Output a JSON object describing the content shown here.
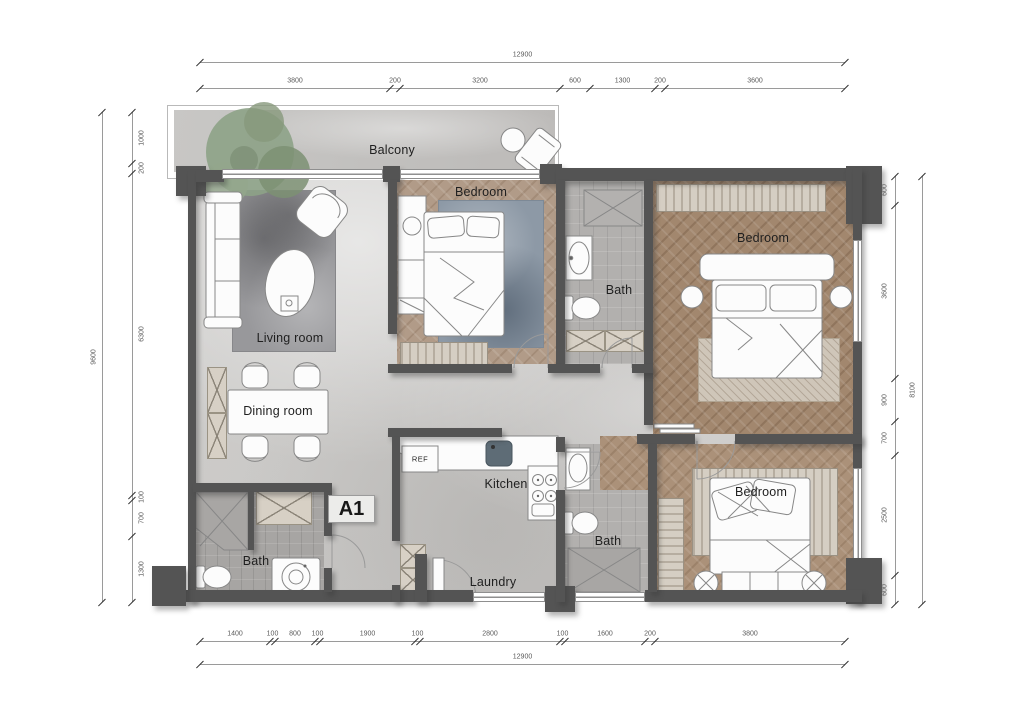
{
  "unit": {
    "label": "A1"
  },
  "rooms": {
    "balcony": "Balcony",
    "bedroom_top": "Bedroom",
    "bedroom_right": "Bedroom",
    "bedroom_bottom": "Bedroom",
    "bath_top": "Bath",
    "bath_bottom_left": "Bath",
    "bath_bottom_middle": "Bath",
    "living": "Living room",
    "dining": "Dining room",
    "kitchen": "Kitchen",
    "laundry": "Laundry",
    "fridge": "REF"
  },
  "dimensions": {
    "top": {
      "total": "12900",
      "segments": [
        3800,
        200,
        3200,
        600,
        1300,
        200,
        3600
      ]
    },
    "bottom": {
      "total": "12900",
      "segments": [
        1400,
        100,
        800,
        100,
        1900,
        100,
        2800,
        100,
        1600,
        200,
        3800
      ]
    },
    "left": {
      "total": "9600",
      "segments": [
        1000,
        200,
        6300,
        100,
        700,
        1300
      ]
    },
    "right": {
      "total": "8100",
      "segments": [
        600,
        3600,
        900,
        700,
        2500,
        600
      ]
    }
  },
  "colors": {
    "wall": "#545454",
    "floor_marble": "#c9c7c5",
    "floor_wood_light": "#b19b88",
    "floor_wood_dark": "#a2876e",
    "floor_tile": "#b2b0ae",
    "rug_blue": "#8d99a6",
    "plant_green": "#87997c",
    "dim_text": "#5a5a5a",
    "label_text": "#1f1f1f"
  }
}
